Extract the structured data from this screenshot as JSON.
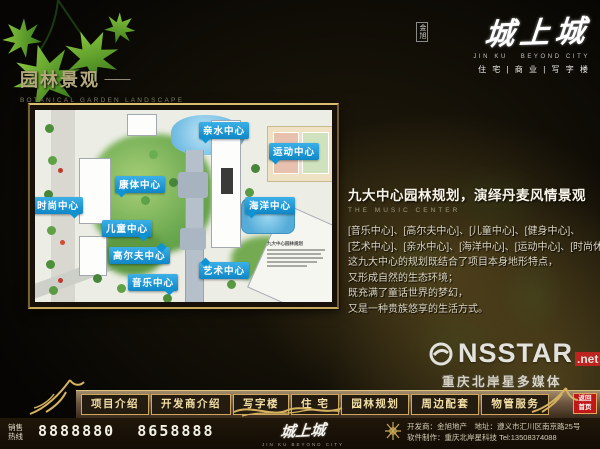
{
  "logo": {
    "name": "城上城",
    "seal": "金旭",
    "latin": "JIN KU   BEYOND CITY",
    "tagline": "住 宅 | 商 业 | 写 字 楼"
  },
  "page_title": {
    "cn": "园林景观",
    "dash": "——",
    "en": "BOTANICAL GARDEN LANDSCAPE"
  },
  "map": {
    "legend_title": "九大中心园林规划",
    "callouts": [
      {
        "label": "亲水中心"
      },
      {
        "label": "运动中心"
      },
      {
        "label": "康体中心"
      },
      {
        "label": "时尚中心"
      },
      {
        "label": "海洋中心"
      },
      {
        "label": "儿童中心"
      },
      {
        "label": "高尔夫中心"
      },
      {
        "label": "艺术中心"
      },
      {
        "label": "音乐中心"
      }
    ]
  },
  "content": {
    "heading": "九大中心园林规划，演绎丹麦风情景观",
    "subheading": "THE MUSIC CENTER",
    "lines": [
      "[音乐中心]、[高尔夫中心]、[儿童中心]、[健身中心]、",
      "[艺术中心]、[亲水中心]、[海洋中心]、[运动中心]、[时尚休闲中心]。",
      "这九大中心的规划既结合了项目本身地形特点，",
      "又形成自然的生态环境；",
      "既充满了童话世界的梦幻，",
      "又是一种贵族悠享的生活方式。"
    ]
  },
  "watermark": {
    "brand": "NSSTAR",
    "suffix": ".net",
    "caption": "重庆北岸星多媒体"
  },
  "nav": {
    "items": [
      {
        "label": "项目介绍"
      },
      {
        "label": "开发商介绍"
      },
      {
        "label": "写字楼"
      },
      {
        "label": "住 宅"
      },
      {
        "label": "园林规划"
      },
      {
        "label": "周边配套"
      },
      {
        "label": "物管服务"
      }
    ],
    "home": {
      "line1": "返回",
      "line2": "首页"
    }
  },
  "footer": {
    "hotline_label_1": "销售",
    "hotline_label_2": "热线",
    "phones": "8888880  8658888",
    "logo": "城上城",
    "dev_line1": "开发商：金旭地产　地址：遵义市汇川区南京路25号",
    "dev_line2": "软件制作：重庆北岸星科技 Tel:13508374088"
  },
  "colors": {
    "callout_blue": "#1697d4",
    "frame_gold": "#d2ac5e",
    "nav_text_gold": "#f3dfa6",
    "home_button_red": "#c01818"
  }
}
